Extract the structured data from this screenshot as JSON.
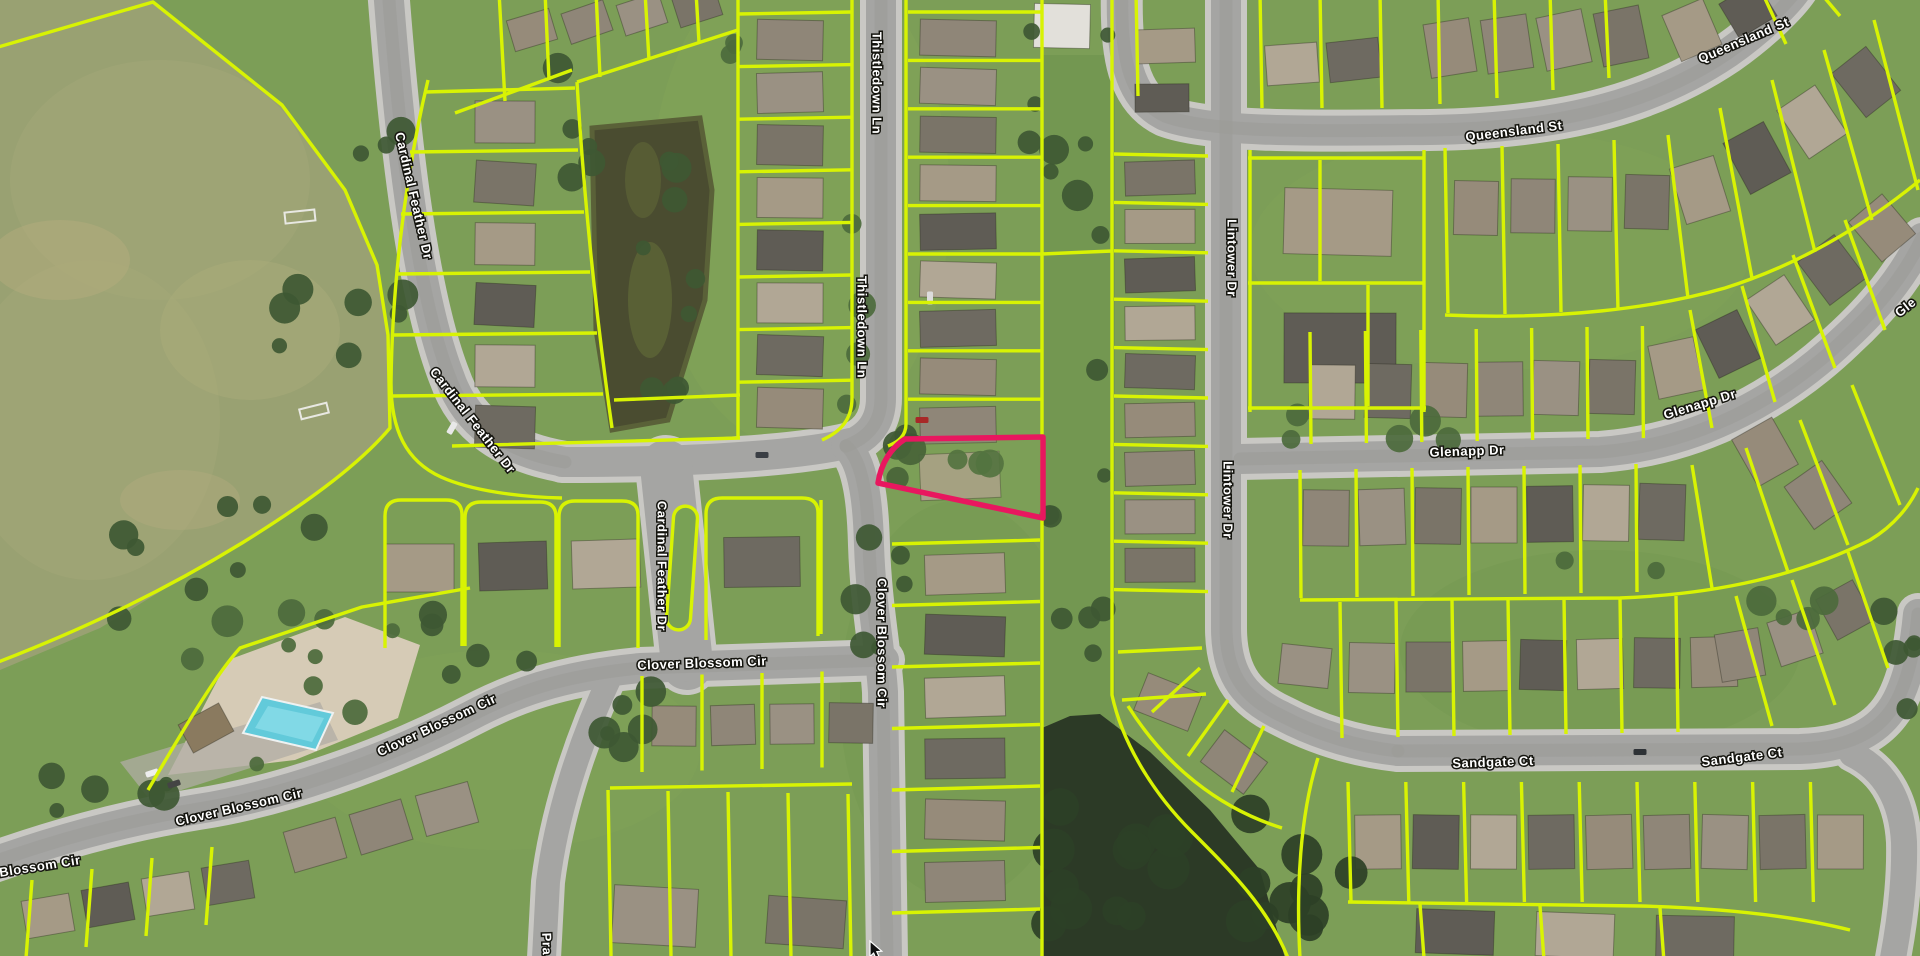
{
  "map": {
    "view": "aerial-parcel-map",
    "street_labels": [
      {
        "text": "Cardinal Feather Dr"
      },
      {
        "text": "Cardinal Feather Dr"
      },
      {
        "text": "Cardinal Feather Dr"
      },
      {
        "text": "Thistledown Ln"
      },
      {
        "text": "Thistledown Ln"
      },
      {
        "text": "Queensland St"
      },
      {
        "text": "Queensland St"
      },
      {
        "text": "Lintower Dr"
      },
      {
        "text": "Lintower Dr"
      },
      {
        "text": "Glenapp Dr"
      },
      {
        "text": "Glenapp Dr"
      },
      {
        "text": "Gle"
      },
      {
        "text": "Sandgate Ct"
      },
      {
        "text": "Sandgate Ct"
      },
      {
        "text": "Clover Blossom Cir"
      },
      {
        "text": "Clover Blossom Cir"
      },
      {
        "text": "Clover Blossom Cir"
      },
      {
        "text": "Clover Blossom Cir"
      },
      {
        "text": "Blossom Cir"
      },
      {
        "text": "Pra"
      }
    ],
    "selected_parcel": {
      "outline_color": "#e8175f",
      "highlighted": true
    },
    "colors": {
      "parcel_line": "#d8f303",
      "road": "#a5a5a3",
      "sidewalk": "#c9c8c4"
    },
    "cursor": {
      "icon": "mouse-pointer",
      "visible": true
    }
  }
}
